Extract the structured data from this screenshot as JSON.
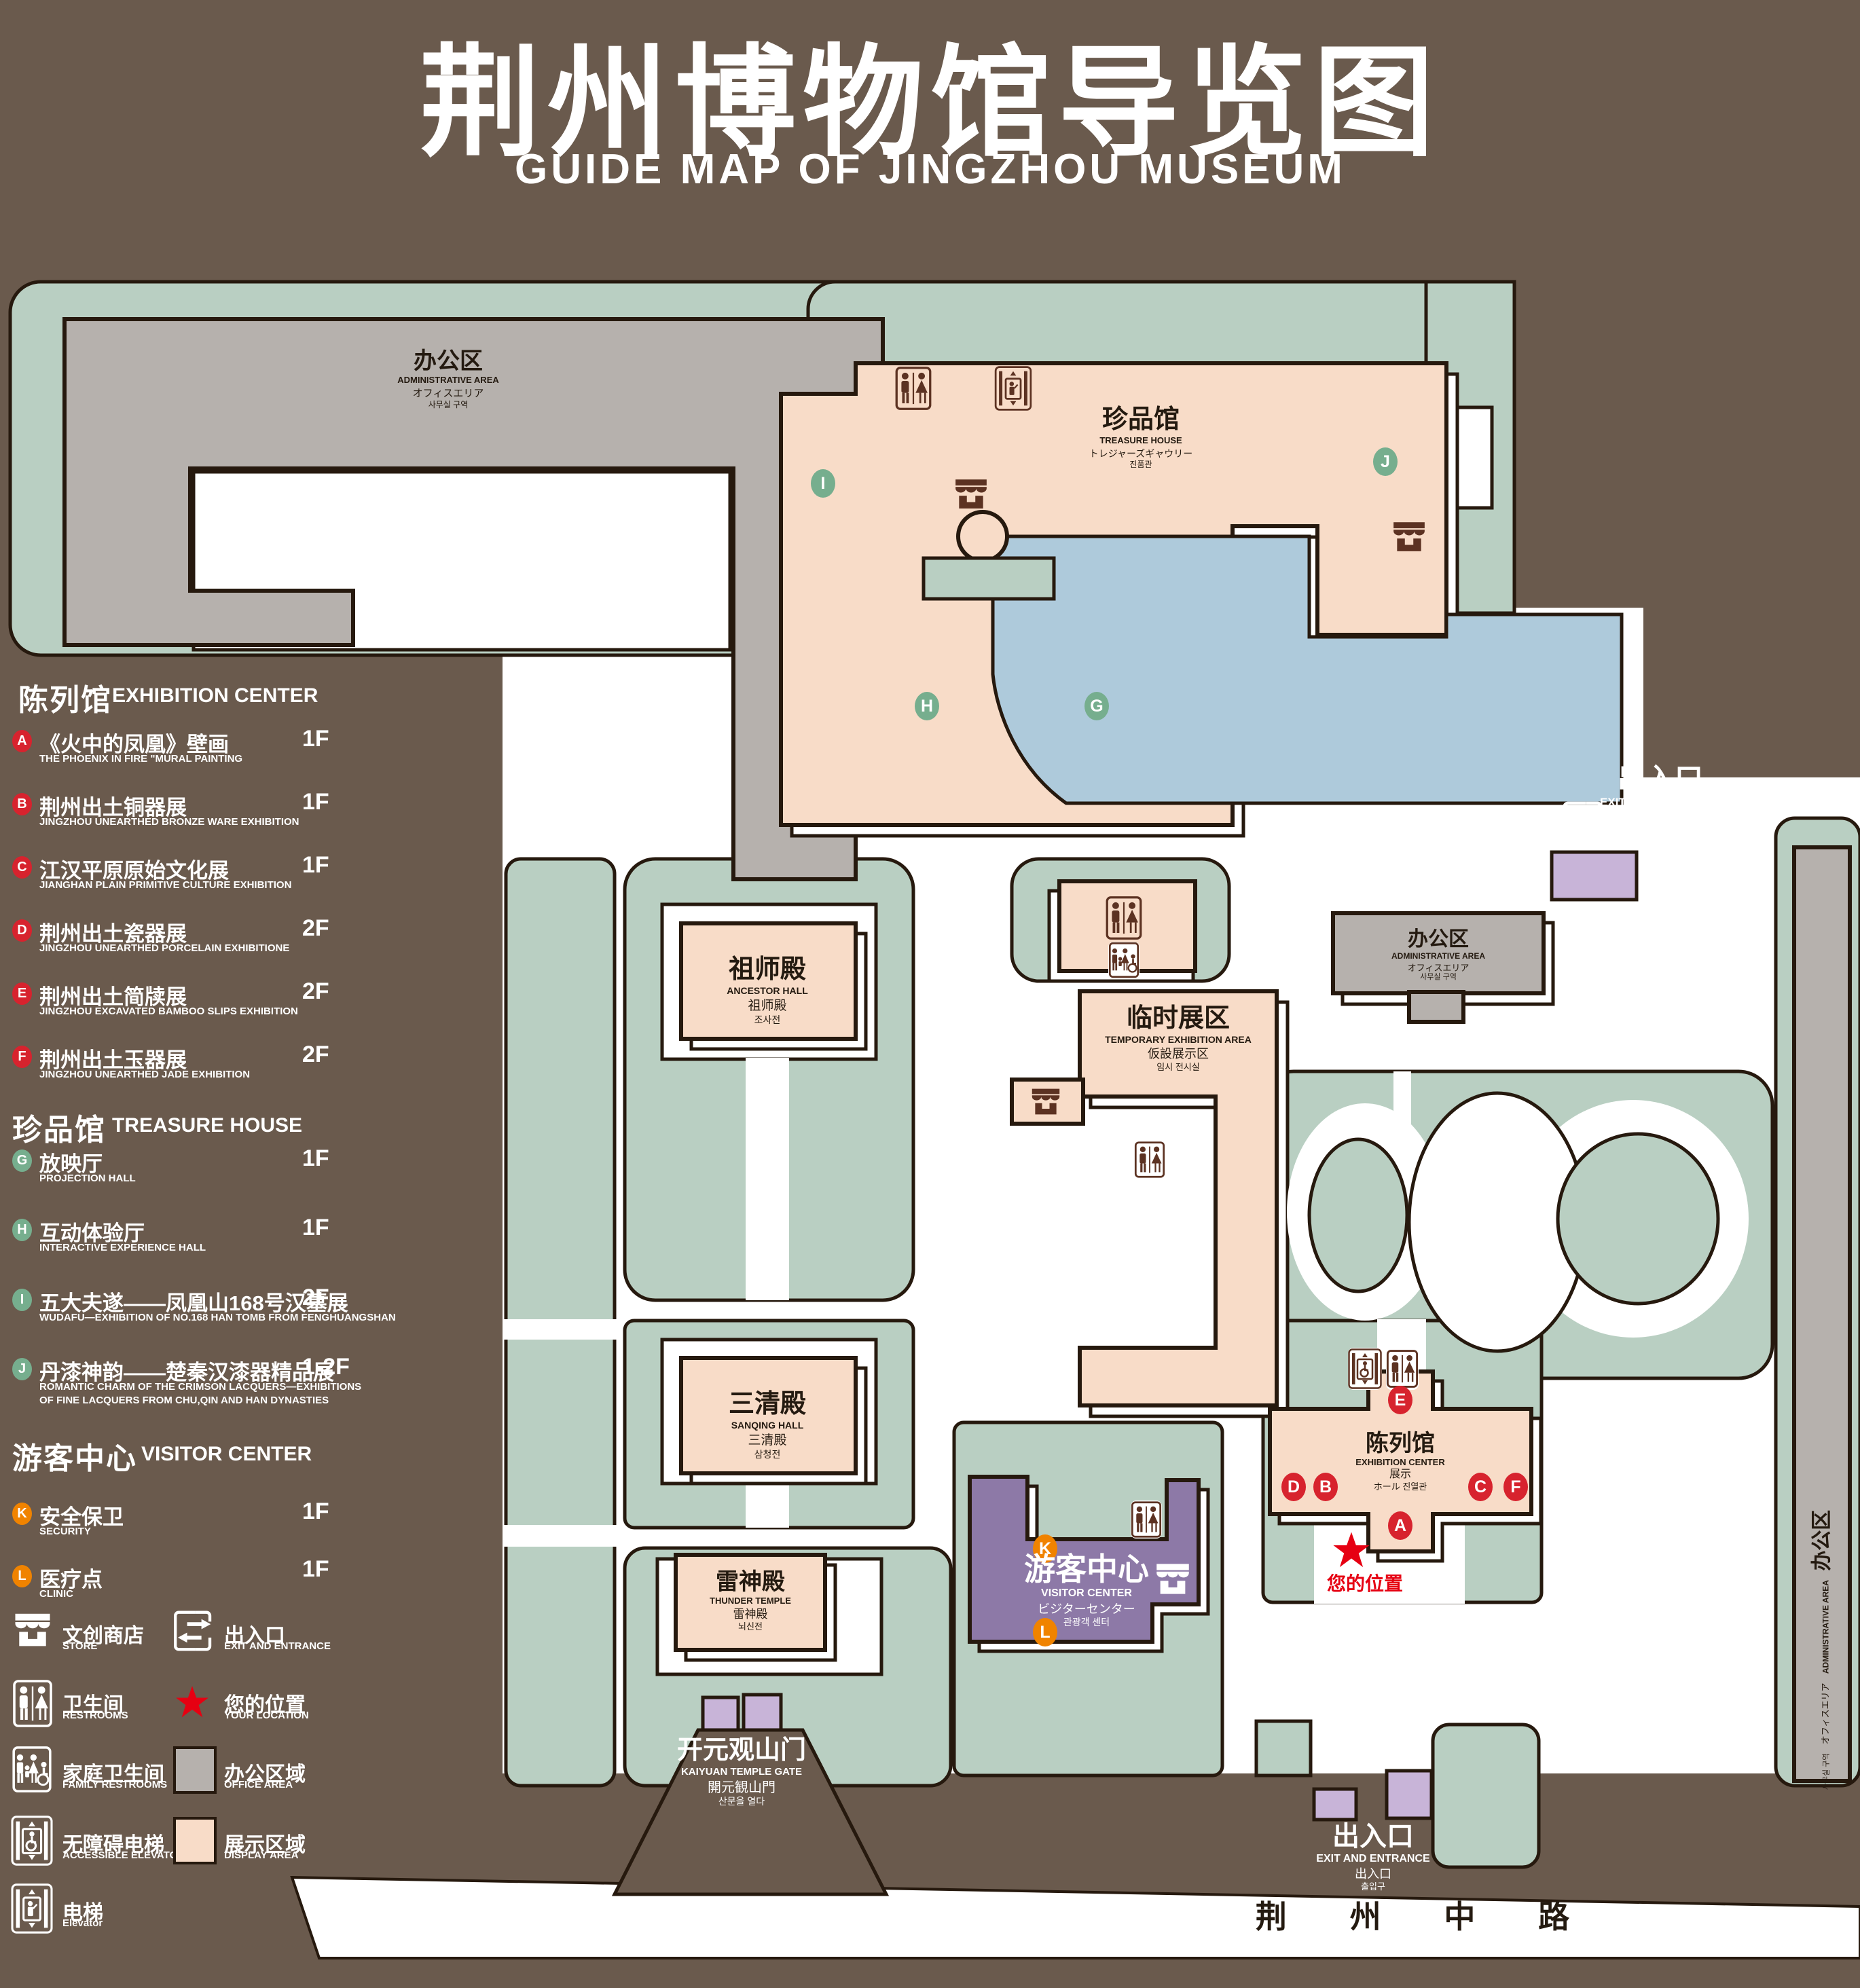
{
  "title": {
    "zh": "荆州博物馆导览图",
    "en": "GUIDE MAP OF JINGZHOU MUSEUM"
  },
  "colors": {
    "background": "#6a5a4d",
    "green_area": "#b9cfc2",
    "display_area": "#f8dcc8",
    "office_area": "#b6b1ad",
    "lake": "#aecadb",
    "visitor_center": "#8d79a7",
    "gate": "#c8b4d8",
    "marker_red": "#d7232e",
    "marker_green": "#76ae8e",
    "marker_orange": "#f08300",
    "star_red": "#e60012"
  },
  "legend": {
    "sections": [
      {
        "zh": "陈列馆",
        "en": "EXHIBITION CENTER",
        "items": [
          {
            "letter": "A",
            "zh": "《火中的凤凰》壁画",
            "en": "THE PHOENIX IN FIRE \"MURAL PAINTING",
            "floor": "1F"
          },
          {
            "letter": "B",
            "zh": "荆州出土铜器展",
            "en": "JINGZHOU UNEARTHED BRONZE WARE EXHIBITION",
            "floor": "1F"
          },
          {
            "letter": "C",
            "zh": "江汉平原原始文化展",
            "en": "JIANGHAN PLAIN PRIMITIVE CULTURE EXHIBITION",
            "floor": "1F"
          },
          {
            "letter": "D",
            "zh": "荆州出土瓷器展",
            "en": "JINGZHOU UNEARTHED PORCELAIN EXHIBITIONE",
            "floor": "2F"
          },
          {
            "letter": "E",
            "zh": "荆州出土简牍展",
            "en": "JINGZHOU EXCAVATED BAMBOO SLIPS EXHIBITION",
            "floor": "2F"
          },
          {
            "letter": "F",
            "zh": "荆州出土玉器展",
            "en": "JINGZHOU UNEARTHED JADE EXHIBITION",
            "floor": "2F"
          }
        ]
      },
      {
        "zh": "珍品馆",
        "en": "TREASURE HOUSE",
        "items": [
          {
            "letter": "G",
            "zh": "放映厅",
            "en": "PROJECTION HALL",
            "floor": "1F"
          },
          {
            "letter": "H",
            "zh": "互动体验厅",
            "en": "INTERACTIVE EXPERIENCE HALL",
            "floor": "1F"
          },
          {
            "letter": "I",
            "zh": "五大夫遂——凤凰山168号汉墓展",
            "en": "WUDAFU—EXHIBITION OF NO.168 HAN TOMB FROM FENGHUANGSHAN",
            "floor": "2F"
          },
          {
            "letter": "J",
            "zh": "丹漆神韵——楚秦汉漆器精品展",
            "en": "ROMANTIC CHARM OF THE CRIMSON LACQUERS—EXHIBITIONS",
            "en2": "OF FINE LACQUERS FROM CHU,QIN AND HAN DYNASTIES",
            "floor": "1-2F"
          }
        ]
      },
      {
        "zh": "游客中心",
        "en": "VISITOR CENTER",
        "items": [
          {
            "letter": "K",
            "zh": "安全保卫",
            "en": "SECURITY",
            "floor": "1F"
          },
          {
            "letter": "L",
            "zh": "医疗点",
            "en": "CLINIC",
            "floor": "1F"
          }
        ]
      }
    ],
    "symbols": {
      "store": {
        "zh": "文创商店",
        "en": "STORE"
      },
      "restrooms": {
        "zh": "卫生间",
        "en": "RESTROOMS"
      },
      "family": {
        "zh": "家庭卫生间",
        "en": "FAMILY RESTROOMS"
      },
      "accessible": {
        "zh": "无障碍电梯",
        "en": "ACCESSIBLE ELEVATOR"
      },
      "elevator": {
        "zh": "电梯",
        "en": "Elevator"
      },
      "exit": {
        "zh": "出入口",
        "en": "EXIT AND ENTRANCE"
      },
      "location": {
        "zh": "您的位置",
        "en": "YOUR LOCATION"
      },
      "office": {
        "zh": "办公区域",
        "en": "OFFICE AREA"
      },
      "display": {
        "zh": "展示区域",
        "en": "DISPLAY AREA"
      }
    }
  },
  "map": {
    "labels": {
      "admin": [
        "办公区",
        "ADMINISTRATIVE AREA",
        "オフィスエリア",
        "사무실 구역"
      ],
      "treasure": [
        "珍品馆",
        "TREASURE HOUSE",
        "トレジャーズギャウリー",
        "진품관"
      ],
      "ancestor": [
        "祖师殿",
        "ANCESTOR HALL",
        "祖师殿",
        "조사전"
      ],
      "sanqing": [
        "三清殿",
        "SANQING HALL",
        "三清殿",
        "삼청전"
      ],
      "temporary": [
        "临时展区",
        "TEMPORARY EXHIBITION AREA",
        "仮設展示区",
        "임시 전시실"
      ],
      "thunder": [
        "雷神殿",
        "THUNDER TEMPLE",
        "雷神殿",
        "뇌신전"
      ],
      "visitor": [
        "游客中心",
        "VISITOR CENTER",
        "ビジターセンター",
        "관광객 센터"
      ],
      "exhibition": [
        "陈列馆",
        "EXHIBITION CENTER",
        "展示",
        "ホール 진열관"
      ],
      "kaiyuan": [
        "开元观山门",
        "KAIYUAN TEMPLE GATE",
        "開元観山門",
        "산문을 열다"
      ],
      "exit": [
        "出入口",
        "EXIT AND ENTRANCE",
        "出入口",
        "출입구"
      ],
      "road": "荆 州 中 路",
      "your_location": "您的位置"
    },
    "markers": {
      "A": "A",
      "B": "B",
      "C": "C",
      "D": "D",
      "E": "E",
      "F": "F",
      "G": "G",
      "H": "H",
      "I": "I",
      "J": "J",
      "K": "K",
      "L": "L"
    }
  }
}
